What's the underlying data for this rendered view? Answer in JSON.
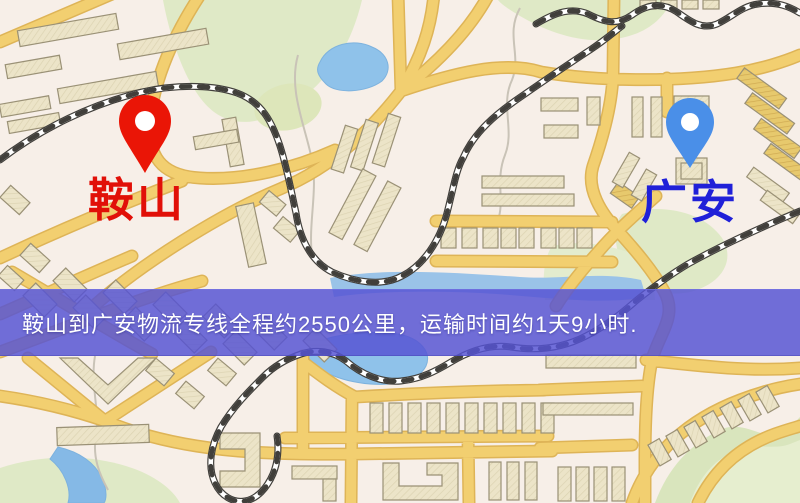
{
  "map": {
    "origin": {
      "name": "鞍山",
      "pin": "red-pin",
      "pin_color": "#ea1506",
      "label_color": "#e11008"
    },
    "destination": {
      "name": "广安",
      "pin": "blue-pin",
      "pin_color": "#4a8fe8",
      "label_color": "#2020d8"
    }
  },
  "banner": {
    "text": "鞍山到广安物流专线全程约2550公里，运输时间约1天9小时.",
    "route": {
      "from": "鞍山",
      "to": "广安",
      "distance": "约2550公里",
      "duration": "约1天9小时"
    },
    "bg_color": "rgba(86,83,211,0.84)",
    "text_color": "#ffffff"
  },
  "palette": {
    "background": "#f7efe8",
    "road_fill": "#f2cf70",
    "road_casing": "#deb457",
    "water": "#8fc2ea",
    "green": "#dfe9c6",
    "building": "#ece4c8",
    "building_outline": "#9a9176",
    "railway": "#413f3b"
  }
}
